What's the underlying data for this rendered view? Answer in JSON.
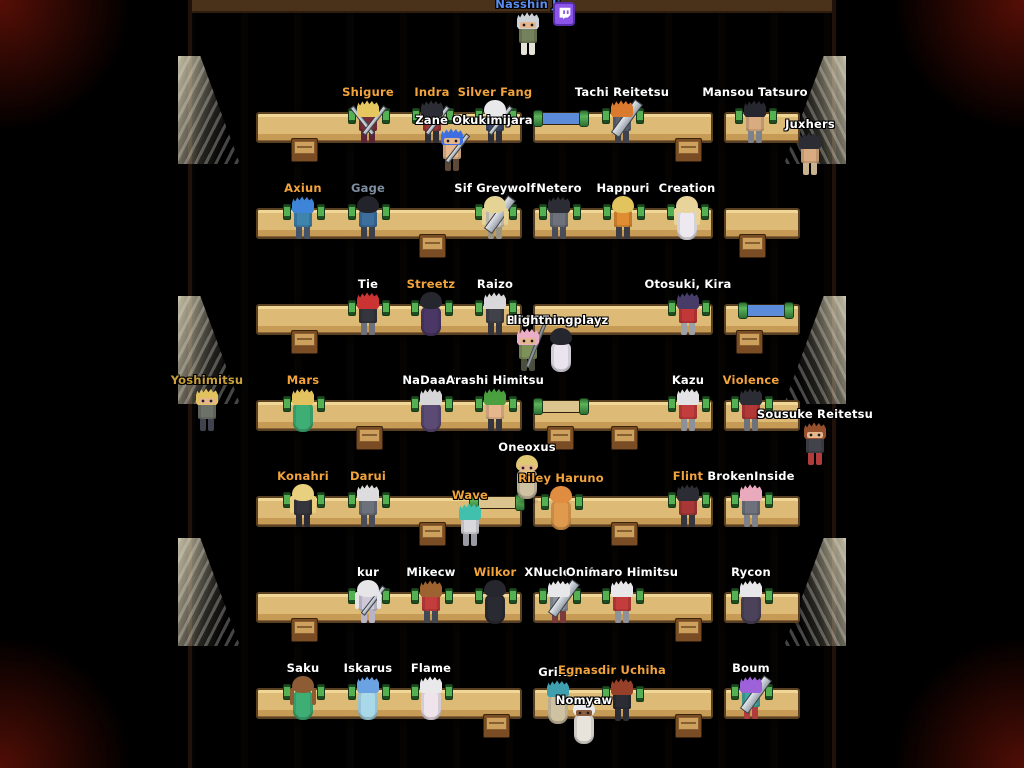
{
  "scene": {
    "name_colors": {
      "white": "#ffffff",
      "orange": "#f2a33c",
      "blue": "#5b8dee",
      "slate": "#7d8ea0",
      "gold_dim": "#c9a13c"
    },
    "floor": {
      "top_bar": "#4a3119"
    },
    "scroll_paper": {
      "blue": "#5c8cd9",
      "tan": "#dcc48e"
    },
    "desk_rows_y": [
      112,
      208,
      304,
      400,
      496,
      592,
      688
    ],
    "desk_segments": [
      {
        "x": 256,
        "w": 266
      },
      {
        "x": 533,
        "w": 180
      },
      {
        "x": 724,
        "w": 76
      }
    ],
    "stools": [
      {
        "row": 0,
        "x": 303
      },
      {
        "row": 0,
        "x": 687
      },
      {
        "row": 1,
        "x": 431
      },
      {
        "row": 1,
        "x": 751
      },
      {
        "row": 2,
        "x": 303
      },
      {
        "row": 2,
        "x": 748
      },
      {
        "row": 3,
        "x": 368
      },
      {
        "row": 3,
        "x": 559
      },
      {
        "row": 3,
        "x": 623
      },
      {
        "row": 4,
        "x": 431
      },
      {
        "row": 4,
        "x": 623
      },
      {
        "row": 5,
        "x": 303
      },
      {
        "row": 5,
        "x": 687
      },
      {
        "row": 6,
        "x": 495
      },
      {
        "row": 6,
        "x": 687
      }
    ],
    "scrolls": [
      {
        "row": 0,
        "x": 561,
        "paper": "blue"
      },
      {
        "row": 2,
        "x": 766,
        "paper": "blue"
      },
      {
        "row": 3,
        "x": 561,
        "paper": "tan"
      },
      {
        "row": 4,
        "x": 497,
        "paper": "tan"
      }
    ],
    "lamps": [
      {
        "side": "left",
        "y": 56
      },
      {
        "side": "left",
        "y": 296
      },
      {
        "side": "left",
        "y": 538
      },
      {
        "side": "right",
        "y": 56
      },
      {
        "side": "right",
        "y": 296
      },
      {
        "side": "right",
        "y": 538
      }
    ],
    "twitch_badge": {
      "x": 553,
      "y": 2
    }
  },
  "players": [
    {
      "name": "Nasshin Ji",
      "x": 528,
      "y": 12,
      "color": "blue",
      "hair": "#cdd2d6",
      "style": "spiky",
      "top": "#75815c",
      "bottom": "#e7e3d8",
      "sword": "none",
      "seated": false,
      "facing": "front",
      "twitch": true
    },
    {
      "name": "Shigure",
      "x": 368,
      "y": 100,
      "color": "orange",
      "hair": "#e7c75f",
      "style": "spiky",
      "top": "#7c2f3a",
      "bottom": "#5c2436",
      "sword": "double",
      "seated": true,
      "facing": "back"
    },
    {
      "name": "Indra",
      "x": 432,
      "y": 100,
      "color": "orange",
      "hair": "#2c2c34",
      "style": "spiky",
      "top": "#9e3636",
      "bottom": "#2e2e36",
      "sword": "slim",
      "seated": true,
      "facing": "back"
    },
    {
      "name": "Silver Fang",
      "x": 495,
      "y": 100,
      "color": "orange",
      "hair": "#e9e9ec",
      "style": "smooth",
      "top": "#3c4867",
      "bottom": "#2e2e36",
      "sword": "slim",
      "seated": true,
      "facing": "back"
    },
    {
      "name": "Zane Okukimijara",
      "x": 452,
      "y": 128,
      "color": "white",
      "hair": "#3e6ee0",
      "style": "spiky",
      "top": "#e6b68c",
      "bottom": "#5d4936",
      "sword": "slim",
      "seated": false,
      "facing": "front",
      "label_dx": 22
    },
    {
      "name": "Tachi Reitetsu",
      "x": 622,
      "y": 100,
      "color": "white",
      "hair": "#d97a2e",
      "style": "spiky",
      "top": "#5d626e",
      "bottom": "#3e424c",
      "sword": "giant",
      "seated": true,
      "facing": "back"
    },
    {
      "name": "Mansou Tatsuro",
      "x": 755,
      "y": 100,
      "color": "white",
      "hair": "#26262e",
      "style": "spiky",
      "top": "#d9ab80",
      "bottom": "#7d828a",
      "sword": "none",
      "seated": true,
      "facing": "back"
    },
    {
      "name": "Juxhers",
      "x": 810,
      "y": 132,
      "color": "white",
      "hair": "#2c2c34",
      "style": "spiky",
      "top": "#d9ab80",
      "bottom": "#c9b38f",
      "sword": "none",
      "seated": false,
      "facing": "left"
    },
    {
      "name": "Axiun",
      "x": 303,
      "y": 196,
      "color": "orange",
      "hair": "#3e85d9",
      "style": "spiky",
      "top": "#3f84ad",
      "bottom": "#44546a",
      "sword": "none",
      "seated": true,
      "facing": "back"
    },
    {
      "name": "Gage",
      "x": 368,
      "y": 196,
      "color": "slate",
      "hair": "#23232b",
      "style": "smooth",
      "top": "#3c6f9e",
      "bottom": "#3a3f4a",
      "sword": "none",
      "seated": true,
      "facing": "back"
    },
    {
      "name": "Sif Greywolf",
      "x": 495,
      "y": 196,
      "color": "white",
      "hair": "#e4d394",
      "style": "long",
      "top": "#d6cfc0",
      "bottom": "#9a9484",
      "sword": "giant",
      "seated": true,
      "facing": "back"
    },
    {
      "name": "Netero",
      "x": 559,
      "y": 196,
      "color": "white",
      "hair": "#2c2c34",
      "style": "spiky",
      "top": "#6d717b",
      "bottom": "#494d57",
      "sword": "none",
      "seated": true,
      "facing": "back"
    },
    {
      "name": "Happuri",
      "x": 623,
      "y": 196,
      "color": "white",
      "hair": "#e2c45f",
      "style": "smooth",
      "top": "#df8c32",
      "bottom": "#3c3c44",
      "sword": "none",
      "seated": true,
      "facing": "back"
    },
    {
      "name": "Creation",
      "x": 687,
      "y": 196,
      "color": "white",
      "hair": "#e8d49a",
      "style": "long",
      "top": "#eee9f1",
      "robe": true,
      "sword": "none",
      "seated": true,
      "facing": "back"
    },
    {
      "name": "Tie",
      "x": 368,
      "y": 292,
      "color": "white",
      "hair": "#cc3333",
      "style": "spiky",
      "top": "#35353d",
      "bottom": "#6d717b",
      "sword": "none",
      "seated": true,
      "facing": "back"
    },
    {
      "name": "Streetz",
      "x": 431,
      "y": 292,
      "color": "orange",
      "hair": "#26262e",
      "style": "smooth",
      "top": "#4b3766",
      "robe": true,
      "sword": "none",
      "seated": true,
      "facing": "back"
    },
    {
      "name": "Raizo",
      "x": 495,
      "y": 292,
      "color": "white",
      "hair": "#d9d9db",
      "style": "spiky",
      "top": "#41414a",
      "bottom": "#35353d",
      "sword": "none",
      "seated": true,
      "facing": "back"
    },
    {
      "name": "BEAST",
      "x": 528,
      "y": 328,
      "color": "white",
      "hair": "#eaaec6",
      "style": "spiky",
      "top": "#7e9159",
      "bottom": "#4a4e3a",
      "sword": "polearm",
      "seated": false,
      "facing": "front"
    },
    {
      "name": "lightningplayz",
      "x": 561,
      "y": 328,
      "color": "white",
      "hair": "#26262e",
      "style": "smooth",
      "top": "#e9e4ee",
      "robe": true,
      "sword": "none",
      "seated": false,
      "facing": "back"
    },
    {
      "name": "Otosuki, Kira",
      "x": 688,
      "y": 292,
      "color": "white",
      "hair": "#473b68",
      "style": "spiky",
      "top": "#c23737",
      "bottom": "#9aa0a6",
      "sword": "none",
      "seated": true,
      "facing": "back"
    },
    {
      "name": "Yoshimitsu",
      "x": 207,
      "y": 388,
      "color": "gold_dim",
      "hair": "#e2c25f",
      "style": "spiky",
      "top": "#6d7168",
      "bottom": "#3f434d",
      "sword": "none",
      "seated": false,
      "facing": "front"
    },
    {
      "name": "Mars",
      "x": 303,
      "y": 388,
      "color": "orange",
      "hair": "#e2c25f",
      "style": "spiky",
      "top": "#3fae74",
      "robe": true,
      "sword": "none",
      "seated": true,
      "facing": "back"
    },
    {
      "name": "NaDaara",
      "x": 431,
      "y": 388,
      "color": "white",
      "hair": "#d6d6d9",
      "style": "spiky",
      "top": "#5b4a74",
      "robe": true,
      "sword": "none",
      "seated": true,
      "facing": "back"
    },
    {
      "name": "Arashi Himitsu",
      "x": 495,
      "y": 388,
      "color": "white",
      "hair": "#4aa03f",
      "style": "spiky",
      "top": "#e6b68c",
      "bottom": "#35353d",
      "sword": "none",
      "seated": true,
      "facing": "back"
    },
    {
      "name": "Kazu",
      "x": 688,
      "y": 388,
      "color": "white",
      "hair": "#e3e3e5",
      "style": "spiky",
      "top": "#c33d3d",
      "bottom": "#8d929a",
      "sword": "none",
      "seated": true,
      "facing": "back"
    },
    {
      "name": "Violence",
      "x": 751,
      "y": 388,
      "color": "orange",
      "hair": "#2c2c34",
      "style": "spiky",
      "top": "#b23737",
      "bottom": "#6d727a",
      "sword": "none",
      "seated": true,
      "facing": "back"
    },
    {
      "name": "Sousuke Reitetsu",
      "x": 815,
      "y": 422,
      "color": "white",
      "hair": "#96502c",
      "style": "spiky",
      "top": "#43434c",
      "bottom": "#b03c3c",
      "sword": "none",
      "seated": false,
      "facing": "front"
    },
    {
      "name": "Oneoxus",
      "x": 527,
      "y": 455,
      "color": "white",
      "hair": "#e0c875",
      "style": "smooth",
      "top": "#cfc2a2",
      "robe": true,
      "sword": "none",
      "seated": false,
      "facing": "front"
    },
    {
      "name": "Konahri",
      "x": 303,
      "y": 484,
      "color": "orange",
      "hair": "#e9d07e",
      "style": "long",
      "top": "#35353d",
      "bottom": "#2c2c34",
      "sword": "none",
      "seated": true,
      "facing": "back"
    },
    {
      "name": "Darui",
      "x": 368,
      "y": 484,
      "color": "orange",
      "hair": "#dddde0",
      "style": "spiky",
      "top": "#6d717b",
      "bottom": "#494d57",
      "sword": "none",
      "seated": true,
      "facing": "back"
    },
    {
      "name": "Wave",
      "x": 470,
      "y": 503,
      "color": "orange",
      "hair": "#41c0ad",
      "style": "spiky",
      "top": "#d9d9dd",
      "bottom": "#9a9aa4",
      "sword": "none",
      "seated": false,
      "facing": "left"
    },
    {
      "name": "Riley Haruno",
      "x": 561,
      "y": 486,
      "color": "orange",
      "hair": "#e08c41",
      "style": "smooth",
      "top": "#e09a4d",
      "robe": true,
      "sword": "none",
      "seated": true,
      "facing": "back"
    },
    {
      "name": "Flint",
      "x": 688,
      "y": 484,
      "color": "orange",
      "hair": "#2c2c34",
      "style": "spiky",
      "top": "#a83737",
      "bottom": "#35353d",
      "sword": "none",
      "seated": true,
      "facing": "back"
    },
    {
      "name": "BrokenInside",
      "x": 751,
      "y": 484,
      "color": "white",
      "hair": "#eaaabd",
      "style": "spiky",
      "top": "#6d717b",
      "bottom": "#7d828a",
      "sword": "none",
      "seated": true,
      "facing": "back"
    },
    {
      "name": "kur",
      "x": 368,
      "y": 580,
      "color": "white",
      "hair": "#e6e6e9",
      "style": "long",
      "top": "#cfc9d9",
      "bottom": "#b9b3c6",
      "sword": "slim",
      "seated": true,
      "facing": "back"
    },
    {
      "name": "Mikecw",
      "x": 431,
      "y": 580,
      "color": "white",
      "hair": "#9e6230",
      "style": "spiky",
      "top": "#c33d3d",
      "bottom": "#424755",
      "sword": "none",
      "seated": true,
      "facing": "back"
    },
    {
      "name": "Wilkor",
      "x": 495,
      "y": 580,
      "color": "orange",
      "hair": "#26262e",
      "style": "smooth",
      "top": "#2a2a32",
      "robe": true,
      "sword": "none",
      "seated": true,
      "facing": "back"
    },
    {
      "name": "XNuclearX",
      "x": 559,
      "y": 580,
      "color": "white",
      "hair": "#e8e8ea",
      "style": "spiky",
      "top": "#8d929a",
      "bottom": "#7c3a3a",
      "sword": "giant",
      "seated": true,
      "facing": "back"
    },
    {
      "name": "Onimaro Himitsu",
      "x": 622,
      "y": 580,
      "color": "white",
      "hair": "#e8e8ea",
      "style": "spiky",
      "top": "#c33d3d",
      "bottom": "#8d929a",
      "sword": "none",
      "seated": true,
      "facing": "back"
    },
    {
      "name": "Rycon",
      "x": 751,
      "y": 580,
      "color": "white",
      "hair": "#e8e8ea",
      "style": "spiky",
      "top": "#4b4259",
      "robe": true,
      "sword": "none",
      "seated": true,
      "facing": "back"
    },
    {
      "name": "Saku",
      "x": 303,
      "y": 676,
      "color": "white",
      "hair": "#8d5c34",
      "style": "long",
      "top": "#3fae74",
      "robe": true,
      "sword": "none",
      "seated": true,
      "facing": "back"
    },
    {
      "name": "Iskarus",
      "x": 368,
      "y": 676,
      "color": "white",
      "hair": "#6ba2e2",
      "style": "spiky",
      "top": "#a9d9e9",
      "robe": true,
      "sword": "none",
      "seated": true,
      "facing": "back"
    },
    {
      "name": "Flame",
      "x": 431,
      "y": 676,
      "color": "white",
      "hair": "#e9e9ec",
      "style": "spiky",
      "top": "#efe3ec",
      "robe": true,
      "sword": "none",
      "seated": true,
      "facing": "back"
    },
    {
      "name": "Grilox",
      "x": 558,
      "y": 680,
      "color": "white",
      "hair": "#3f9fae",
      "style": "spiky",
      "top": "#cfc2a2",
      "robe": true,
      "sword": "none",
      "seated": false,
      "facing": "back"
    },
    {
      "name": "Egnasdir Uchiha",
      "x": 622,
      "y": 678,
      "color": "orange",
      "hair": "#96402a",
      "style": "spiky",
      "top": "#2c2c34",
      "bottom": "#2c2c34",
      "sword": "none",
      "seated": true,
      "facing": "back",
      "label_dx": -10
    },
    {
      "name": "Boum",
      "x": 751,
      "y": 676,
      "color": "white",
      "hair": "#9d62da",
      "style": "spiky",
      "top": "#3fa89e",
      "bottom": "#b03c3c",
      "sword": "giant",
      "seated": true,
      "facing": "back"
    },
    {
      "name": "Nomyaw",
      "x": 584,
      "y": 700,
      "color": "white",
      "hair": "#e9e9ec",
      "style": "smooth",
      "top": "#e8e4dc",
      "robe": true,
      "sword": "none",
      "seated": false,
      "facing": "front",
      "skin": "dark",
      "label_dy": 8
    }
  ]
}
